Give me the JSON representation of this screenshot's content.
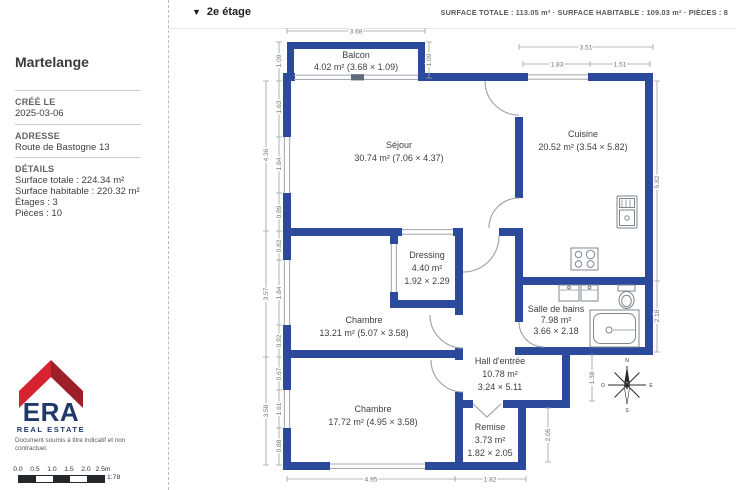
{
  "header": {
    "floor_label": "2e étage",
    "dropdown_glyph": "▼",
    "summary": "SURFACE TOTALE : 113.05 m² · SURFACE HABITABLE : 109.03 m² · PIÈCES : 8"
  },
  "sidebar": {
    "title": "Martelange",
    "created": {
      "label": "CRÉÉ LE",
      "value": "2025-03-06"
    },
    "address": {
      "label": "ADRESSE",
      "value": "Route de Bastogne 13"
    },
    "details": {
      "label": "DÉTAILS",
      "lines": [
        "Surface totale : 224.34 m²",
        "Surface habitable : 220.32 m²",
        "Étages : 3",
        "Pièces : 10"
      ]
    },
    "logo": {
      "name": "ERA",
      "tagline": "REAL ESTATE",
      "red": "#d7232f",
      "dark_red": "#9e1f2a",
      "navy": "#20386b"
    },
    "disclaimer": "Document soumis à titre indicatif et non contractuel.",
    "scale": {
      "labels": [
        "0.0",
        "0.5",
        "1.0",
        "1.5",
        "2.0",
        "2.5m"
      ],
      "ratio": "1:78"
    }
  },
  "plan": {
    "wall_color": "#2b4a9b",
    "rooms": [
      {
        "name": "Balcon",
        "lines": [
          "4.02 m² (3.68 × 1.09)"
        ]
      },
      {
        "name": "Séjour",
        "lines": [
          "30.74 m² (7.06 × 4.37)"
        ]
      },
      {
        "name": "Cuisine",
        "lines": [
          "20.52 m² (3.54 × 5.82)"
        ]
      },
      {
        "name": "Dressing",
        "lines": [
          "4.40 m²",
          "1.92 × 2.29"
        ]
      },
      {
        "name": "Chambre",
        "lines": [
          "13.21 m² (5.07 × 3.58)"
        ]
      },
      {
        "name": "Salle de bains",
        "lines": [
          "7.98 m²",
          "3.66 × 2.18"
        ]
      },
      {
        "name": "Hall d'entrée",
        "lines": [
          "10.78 m²",
          "3.24 × 5.11"
        ]
      },
      {
        "name": "Chambre",
        "lines": [
          "17.72 m² (4.95 × 3.58)"
        ]
      },
      {
        "name": "Remise",
        "lines": [
          "3.73 m²",
          "1.82 × 2.05"
        ]
      }
    ],
    "dims": {
      "top": [
        "3.68",
        "3.51",
        "1.83",
        "1.51"
      ],
      "left_outer": [
        "4.36",
        "3.57",
        "3.58"
      ],
      "left_inner": [
        "1.09",
        "1.63",
        "1.84",
        "0.89",
        "0.82",
        "1.84",
        "0.92",
        "0.67",
        "1.61",
        "0.88"
      ],
      "right": [
        "1.09",
        "5.82",
        "2.18",
        "1.38",
        "2.05"
      ],
      "bottom": [
        "4.95",
        "1.82"
      ]
    },
    "compass": {
      "n": "N",
      "s": "S",
      "e": "E",
      "w": "O"
    }
  }
}
